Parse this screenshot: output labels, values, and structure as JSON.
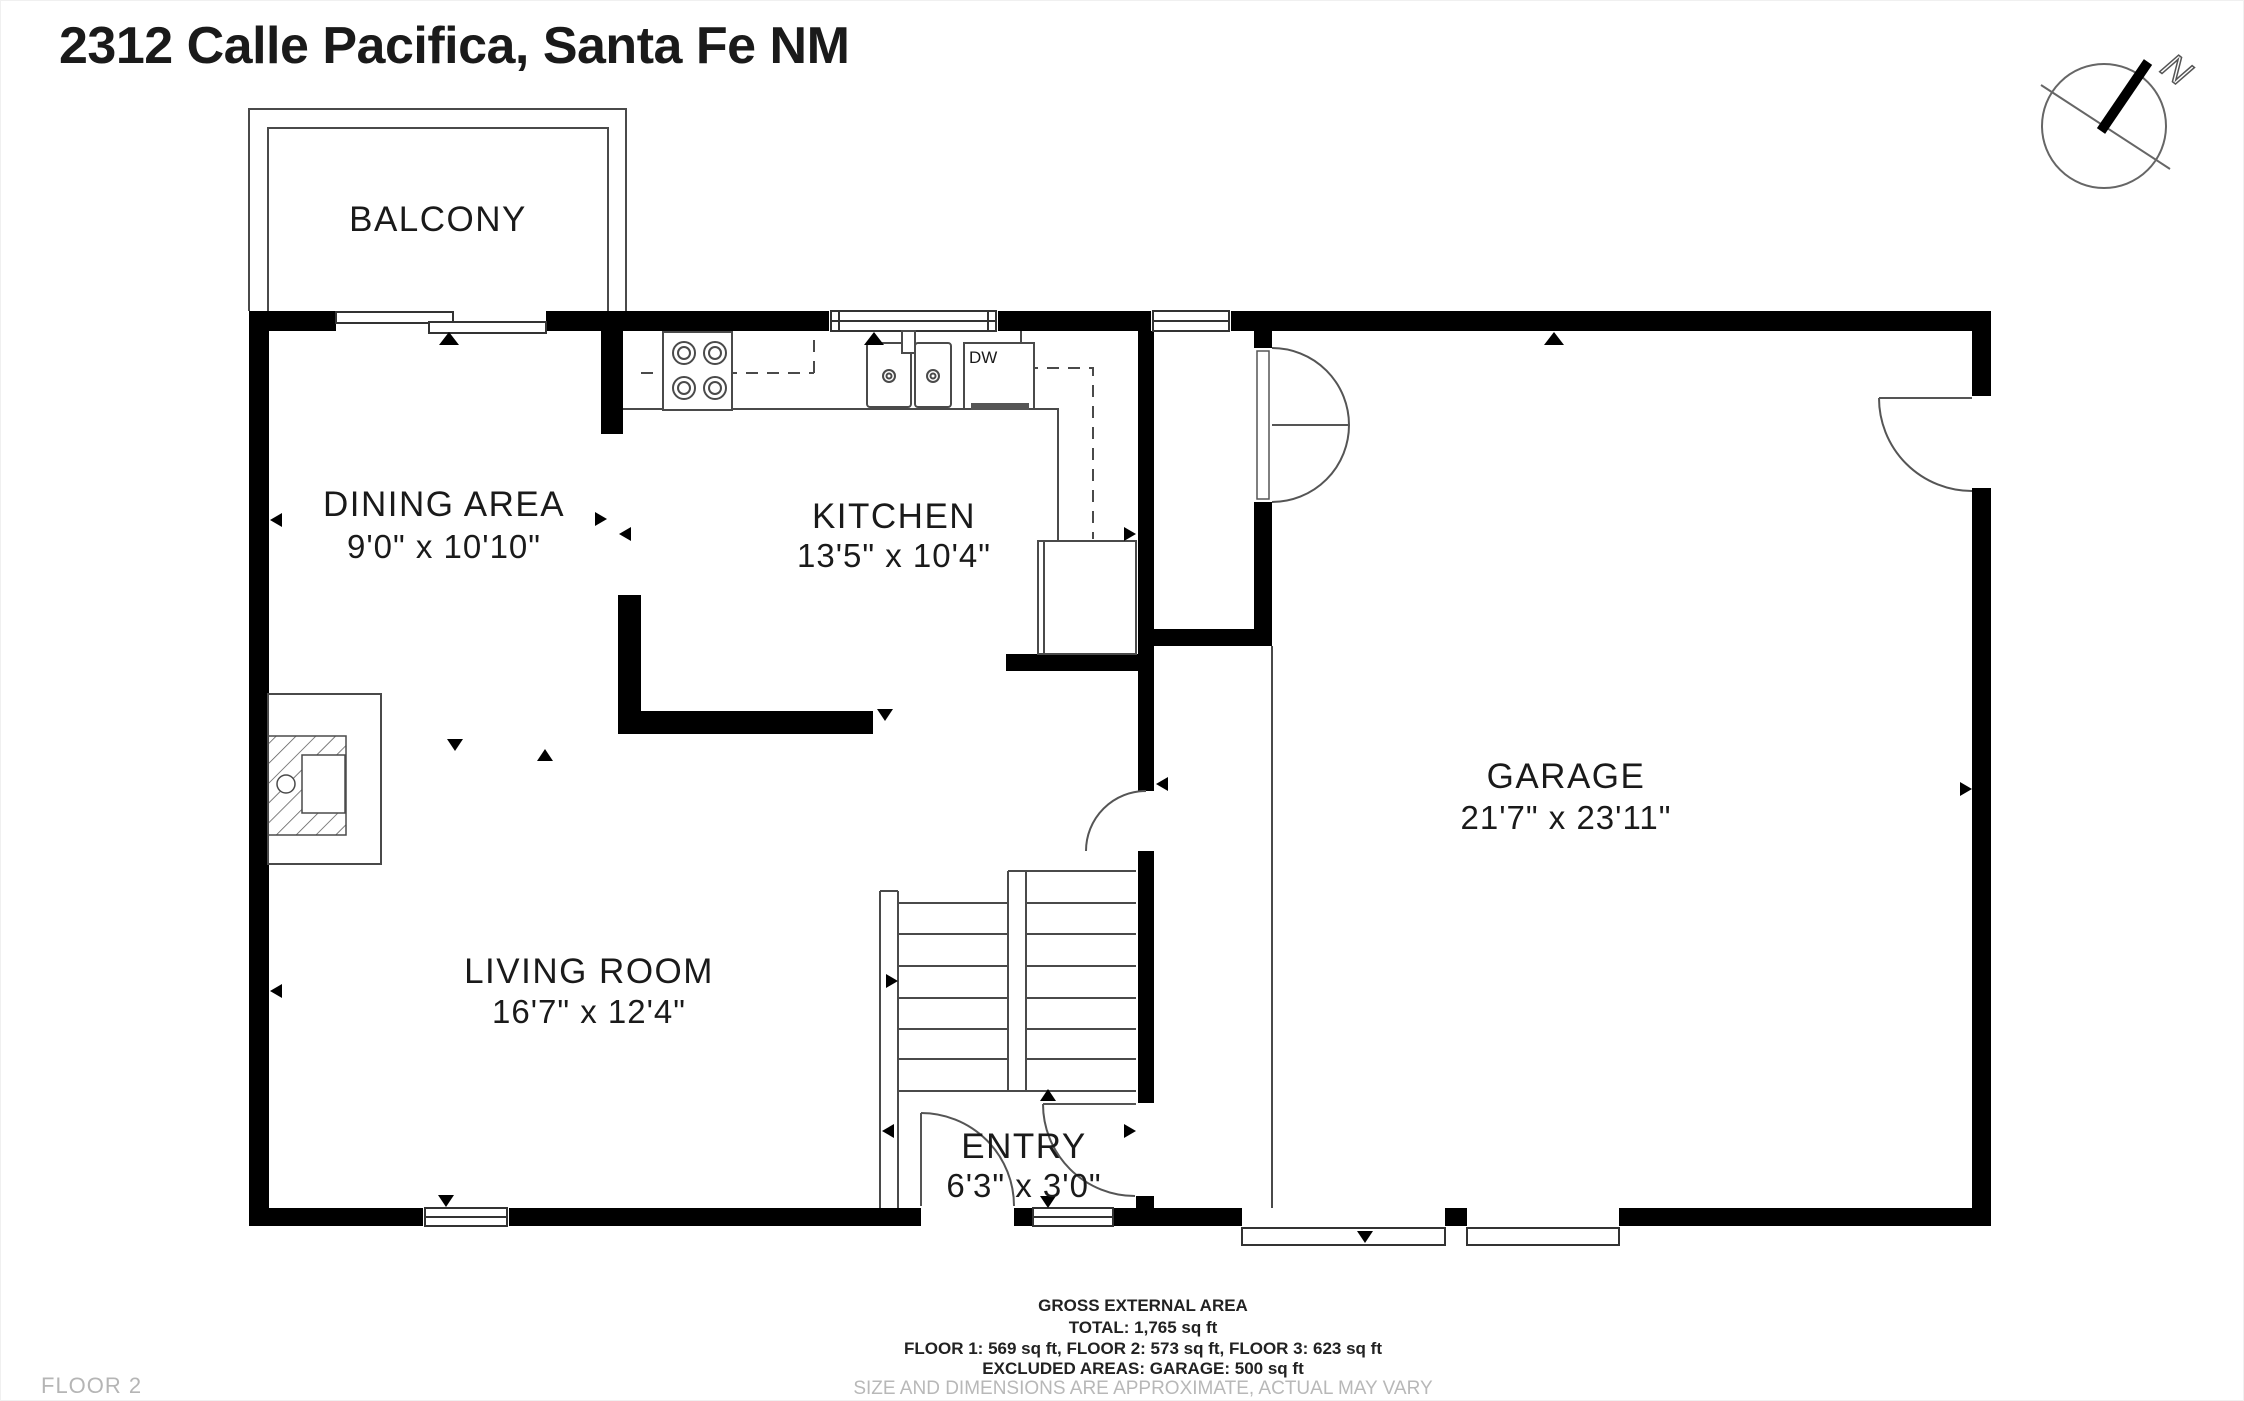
{
  "page": {
    "title": "2312 Calle Pacifica, Santa Fe NM",
    "floor_label": "FLOOR 2"
  },
  "compass": {
    "label": "N"
  },
  "rooms": {
    "balcony": {
      "name": "BALCONY"
    },
    "dining": {
      "name": "DINING AREA",
      "dims": "9'0\" x 10'10\""
    },
    "kitchen": {
      "name": "KITCHEN",
      "dims": "13'5\" x 10'4\""
    },
    "living": {
      "name": "LIVING ROOM",
      "dims": "16'7\" x 12'4\""
    },
    "entry": {
      "name": "ENTRY",
      "dims": "6'3\" x 3'0\""
    },
    "garage": {
      "name": "GARAGE",
      "dims": "21'7\" x 23'11\""
    }
  },
  "appliances": {
    "dishwasher": "DW"
  },
  "footer": {
    "line1": "GROSS EXTERNAL AREA",
    "line2": "TOTAL: 1,765 sq ft",
    "line3": "FLOOR 1: 569 sq ft, FLOOR 2: 573 sq ft, FLOOR 3: 623 sq ft",
    "line4": "EXCLUDED AREAS: GARAGE: 500 sq ft",
    "line5": "SIZE AND DIMENSIONS ARE APPROXIMATE, ACTUAL MAY VARY"
  },
  "colors": {
    "wall": "#000000",
    "line": "#4a4a4a",
    "muted": "#b5b5b5"
  }
}
